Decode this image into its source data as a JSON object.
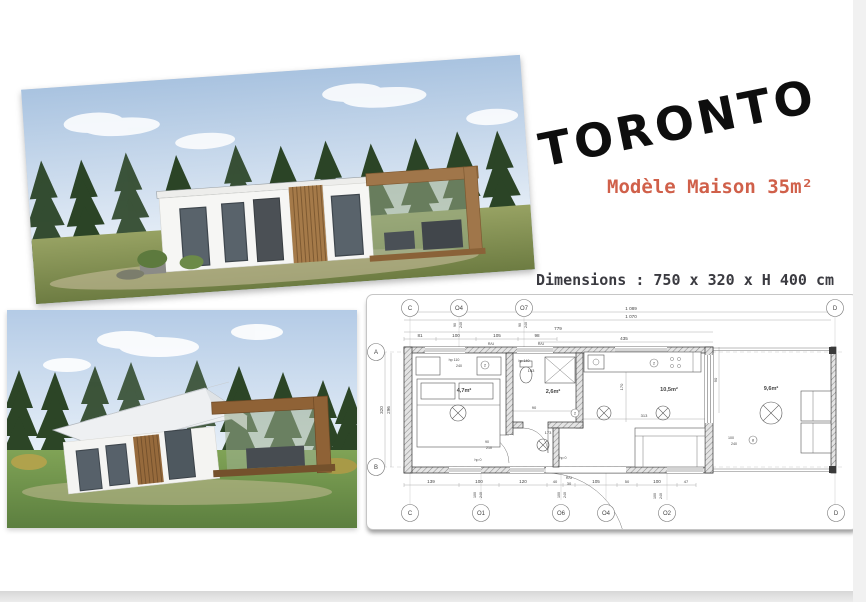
{
  "page": {
    "title": "TORONTO",
    "subtitle": "Modèle Maison 35m²",
    "dimensions_line": "Dimensions : 750 x 320 x H 400 cm"
  },
  "colors": {
    "accent": "#d0604a",
    "text_dark": "#3b3b41",
    "plan_ink": "#444444"
  },
  "floorplan": {
    "rooms": [
      {
        "t": "4,7m²",
        "x": 97,
        "y": 97
      },
      {
        "t": "2,6m²",
        "x": 186,
        "y": 98
      },
      {
        "t": "10,5m²",
        "x": 302,
        "y": 96
      },
      {
        "t": "9,6m²",
        "x": 404,
        "y": 95
      }
    ],
    "bubbles": [
      {
        "t": "C",
        "x": 43,
        "y": 13
      },
      {
        "t": "O4",
        "x": 92,
        "y": 13
      },
      {
        "t": "O7",
        "x": 157,
        "y": 13
      },
      {
        "t": "D",
        "x": 468,
        "y": 13
      },
      {
        "t": "A",
        "x": 9,
        "y": 57
      },
      {
        "t": "B",
        "x": 9,
        "y": 172
      },
      {
        "t": "C",
        "x": 43,
        "y": 218
      },
      {
        "t": "O1",
        "x": 114,
        "y": 218
      },
      {
        "t": "O6",
        "x": 194,
        "y": 218
      },
      {
        "t": "O4",
        "x": 239,
        "y": 218
      },
      {
        "t": "O2",
        "x": 300,
        "y": 218
      },
      {
        "t": "D",
        "x": 469,
        "y": 218
      },
      {
        "t": "8",
        "x": 386,
        "y": 145,
        "small": true
      },
      {
        "t": "2",
        "x": 118,
        "y": 70,
        "small": true
      },
      {
        "t": "2",
        "x": 287,
        "y": 68,
        "small": true
      },
      {
        "t": "2",
        "x": 208,
        "y": 118,
        "small": true
      }
    ],
    "dims": [
      {
        "t": "1 089",
        "x": 264,
        "y": 15
      },
      {
        "t": "1 070",
        "x": 264,
        "y": 23
      },
      {
        "t": "779",
        "x": 191,
        "y": 35
      },
      {
        "t": "81",
        "x": 53,
        "y": 42
      },
      {
        "t": "100",
        "x": 89,
        "y": 42
      },
      {
        "t": "105",
        "x": 130,
        "y": 42
      },
      {
        "t": "98",
        "x": 170,
        "y": 42
      },
      {
        "t": "R/U",
        "x": 124,
        "y": 50,
        "s": 3.6
      },
      {
        "t": "R/U",
        "x": 174,
        "y": 50,
        "s": 3.6
      },
      {
        "t": "435",
        "x": 257,
        "y": 45
      },
      {
        "t": "90",
        "x": 89,
        "y": 30,
        "r": -90,
        "s": 3.6
      },
      {
        "t": "240",
        "x": 95,
        "y": 30,
        "r": -90,
        "s": 3.6
      },
      {
        "t": "90",
        "x": 154,
        "y": 30,
        "r": -90,
        "s": 3.6
      },
      {
        "t": "240",
        "x": 160,
        "y": 30,
        "r": -90,
        "s": 3.6
      },
      {
        "t": "320",
        "x": 16,
        "y": 115,
        "r": -90
      },
      {
        "t": "296",
        "x": 23,
        "y": 115,
        "r": -90
      },
      {
        "t": "170",
        "x": 256,
        "y": 92,
        "r": -90,
        "s": 4
      },
      {
        "t": "90",
        "x": 350,
        "y": 85,
        "r": -90,
        "s": 4
      },
      {
        "t": "hp 110",
        "x": 87,
        "y": 66,
        "s": 3.6
      },
      {
        "t": "240",
        "x": 92,
        "y": 72,
        "s": 3.6
      },
      {
        "t": "hp 140",
        "x": 157,
        "y": 67,
        "s": 3.6
      },
      {
        "t": "163",
        "x": 164,
        "y": 77,
        "s": 4
      },
      {
        "t": "90",
        "x": 167,
        "y": 114,
        "s": 4
      },
      {
        "t": "173",
        "x": 181,
        "y": 139,
        "s": 4
      },
      {
        "t": "313",
        "x": 277,
        "y": 122,
        "s": 4
      },
      {
        "t": "90",
        "x": 120,
        "y": 148,
        "s": 3.6
      },
      {
        "t": "210",
        "x": 122,
        "y": 154,
        "s": 3.6
      },
      {
        "t": "hp 0",
        "x": 111,
        "y": 166,
        "s": 3.6
      },
      {
        "t": "hp 0",
        "x": 196,
        "y": 164,
        "s": 3.6
      },
      {
        "t": "100",
        "x": 364,
        "y": 144,
        "s": 3.6
      },
      {
        "t": "240",
        "x": 367,
        "y": 150,
        "s": 3.6
      },
      {
        "t": "139",
        "x": 64,
        "y": 188
      },
      {
        "t": "100",
        "x": 112,
        "y": 188
      },
      {
        "t": "120",
        "x": 156,
        "y": 188
      },
      {
        "t": "40",
        "x": 188,
        "y": 188,
        "s": 4
      },
      {
        "t": "R/U",
        "x": 202,
        "y": 184,
        "s": 3.6
      },
      {
        "t": "30",
        "x": 202,
        "y": 190,
        "s": 4
      },
      {
        "t": "105",
        "x": 229,
        "y": 188
      },
      {
        "t": "50",
        "x": 260,
        "y": 188,
        "s": 4
      },
      {
        "t": "100",
        "x": 290,
        "y": 188
      },
      {
        "t": "47",
        "x": 319,
        "y": 188,
        "s": 4
      },
      {
        "t": "100",
        "x": 109,
        "y": 200,
        "r": -90,
        "s": 3.6
      },
      {
        "t": "240",
        "x": 115,
        "y": 200,
        "r": -90,
        "s": 3.6
      },
      {
        "t": "100",
        "x": 193,
        "y": 200,
        "r": -90,
        "s": 3.6
      },
      {
        "t": "240",
        "x": 199,
        "y": 200,
        "r": -90,
        "s": 3.6
      },
      {
        "t": "100",
        "x": 289,
        "y": 201,
        "r": -90,
        "s": 3.6
      },
      {
        "t": "240",
        "x": 295,
        "y": 201,
        "r": -90,
        "s": 3.6
      }
    ]
  }
}
